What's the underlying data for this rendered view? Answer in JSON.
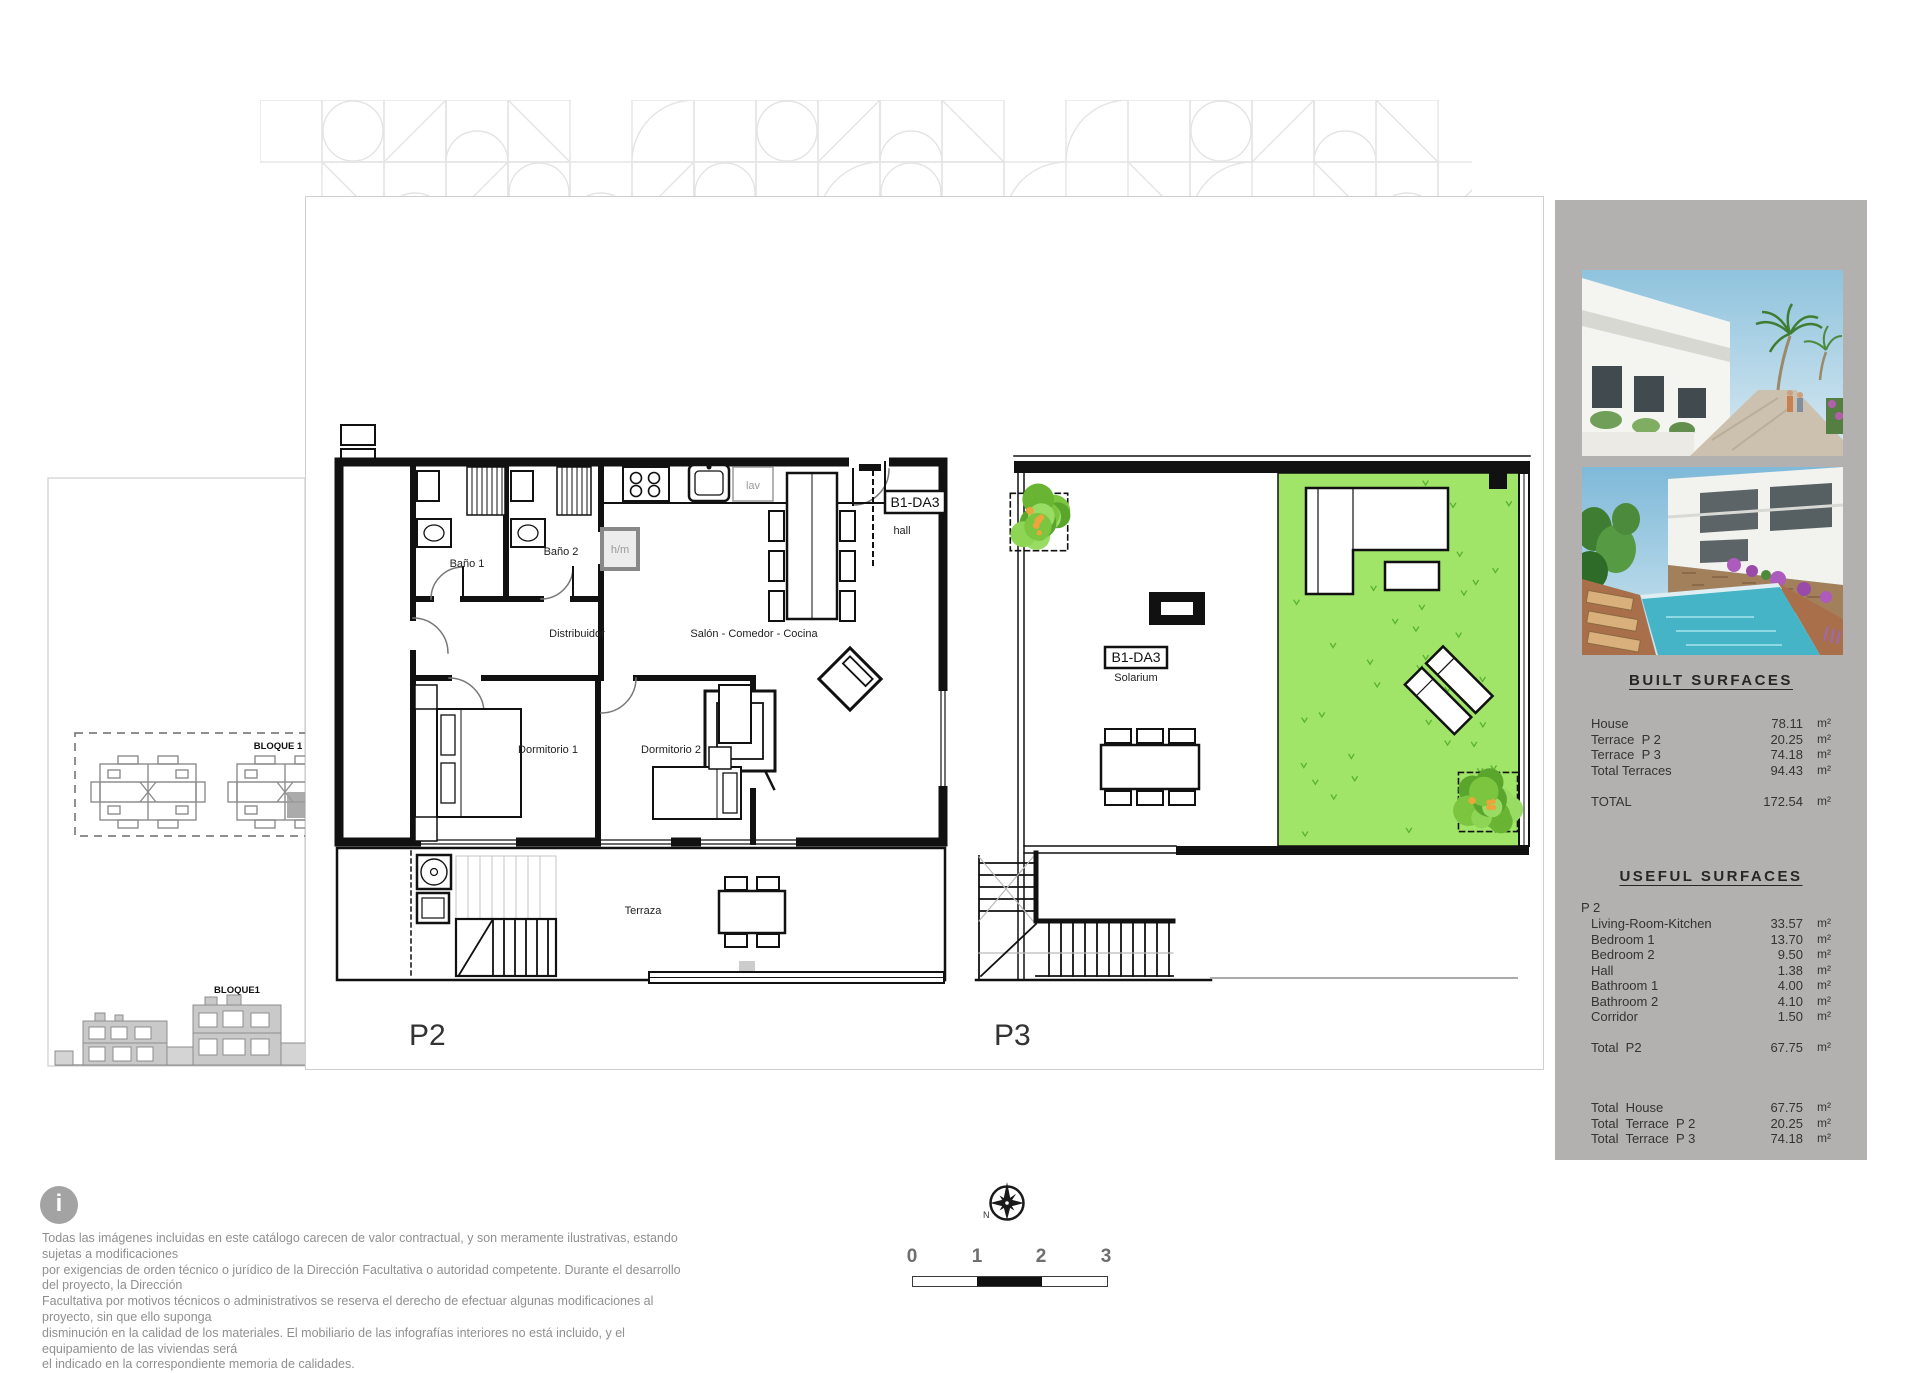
{
  "plans": {
    "p2": {
      "label": "P2",
      "unit_code": "B1-DA3",
      "rooms": {
        "bano1": "Baño 1",
        "bano2": "Baño 2",
        "distribuidor": "Distribuidor",
        "salon": "Salón - Comedor - Cocina",
        "dormitorio1": "Dormitorio 1",
        "dormitorio2": "Dormitorio 2",
        "hall": "hall",
        "hm": "h/m",
        "lav": "lav",
        "terraza": "Terraza"
      }
    },
    "p3": {
      "label": "P3",
      "unit_code": "B1-DA3",
      "room": "Solarium"
    }
  },
  "site": {
    "block_label": "BLOQUE 1",
    "elevation_label": "BLOQUE1"
  },
  "sidebar": {
    "built": {
      "title": "BUILT  SURFACES",
      "rows": [
        [
          "House",
          "78.11",
          "m²"
        ],
        [
          "Terrace  P 2",
          "20.25",
          "m²"
        ],
        [
          "Terrace  P 3",
          "74.18",
          "m²"
        ],
        [
          "Total Terraces",
          "94.43",
          "m²"
        ]
      ],
      "total": [
        "TOTAL",
        "172.54",
        "m²"
      ]
    },
    "useful": {
      "title": "USEFUL  SURFACES",
      "group": "P 2",
      "rows": [
        [
          "Living-Room-Kitchen",
          "33.57",
          "m²"
        ],
        [
          "Bedroom 1",
          "13.70",
          "m²"
        ],
        [
          "Bedroom 2",
          "9.50",
          "m²"
        ],
        [
          "Hall",
          "1.38",
          "m²"
        ],
        [
          "Bathroom 1",
          "4.00",
          "m²"
        ],
        [
          "Bathroom 2",
          "4.10",
          "m²"
        ],
        [
          "Corridor",
          "1.50",
          "m²"
        ]
      ],
      "total": [
        "Total  P2",
        "67.75",
        "m²"
      ]
    },
    "totals": [
      [
        "Total  House",
        "67.75",
        "m²"
      ],
      [
        "Total  Terrace  P 2",
        "20.25",
        "m²"
      ],
      [
        "Total  Terrace  P 3",
        "74.18",
        "m²"
      ]
    ]
  },
  "footer": {
    "info_icon": "i",
    "disclaimer_lines": [
      "Todas las imágenes incluidas en este catálogo carecen de valor contractual, y son meramente ilustrativas, estando sujetas a modificaciones",
      "por exigencias de  orden técnico o jurídico de la Dirección Facultativa o autoridad competente. Durante el desarrollo del proyecto, la Dirección",
      "Facultativa por motivos técnicos o administrativos se reserva el derecho de efectuar algunas modificaciones al proyecto, sin que ello suponga",
      "disminución  en la calidad de los materiales. El mobiliario de las infografías interiores no está incluido, y el equipamiento de las viviendas será",
      "el indicado en la correspondiente memoria de calidades."
    ],
    "compass_north": "N",
    "scale_ticks": [
      "0",
      "1",
      "2",
      "3"
    ]
  },
  "colors": {
    "lawn": "#a0e468",
    "sprig": "#58b232",
    "panel": "#b3b1b0"
  }
}
